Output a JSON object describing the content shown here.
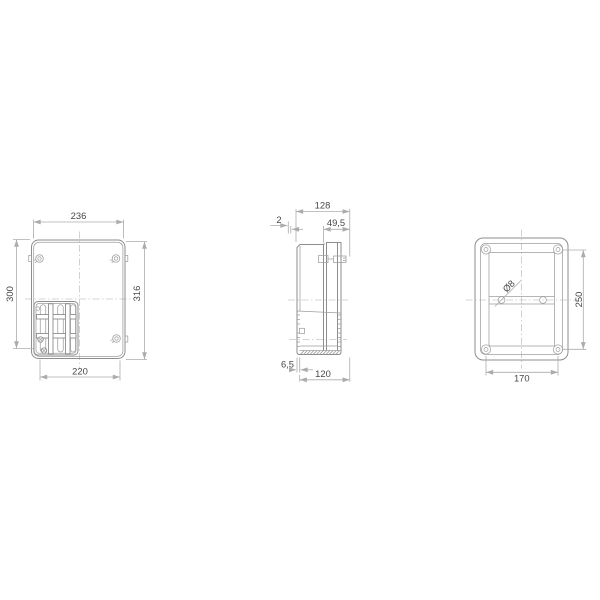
{
  "drawing_type": "enclosure-3-view-technical-drawing",
  "views": {
    "front": {
      "width_top": "236",
      "height_left": "300",
      "height_right": "316",
      "width_bottom": "220"
    },
    "side": {
      "total_depth": "128",
      "lip": "2",
      "lid_depth": "49,5",
      "wall": "6,5",
      "base_depth": "120"
    },
    "back": {
      "hole_diameter": "Ø8",
      "hole_spacing_vertical": "250",
      "hole_spacing_horizontal": "170"
    }
  },
  "colors": {
    "line": "#8d8d8d",
    "line_light": "#9e9e9e",
    "dim": "#acacac",
    "centerline": "#c6c6c6",
    "text": "#45474b",
    "background": "#ffffff",
    "fill": "#ffffff"
  }
}
